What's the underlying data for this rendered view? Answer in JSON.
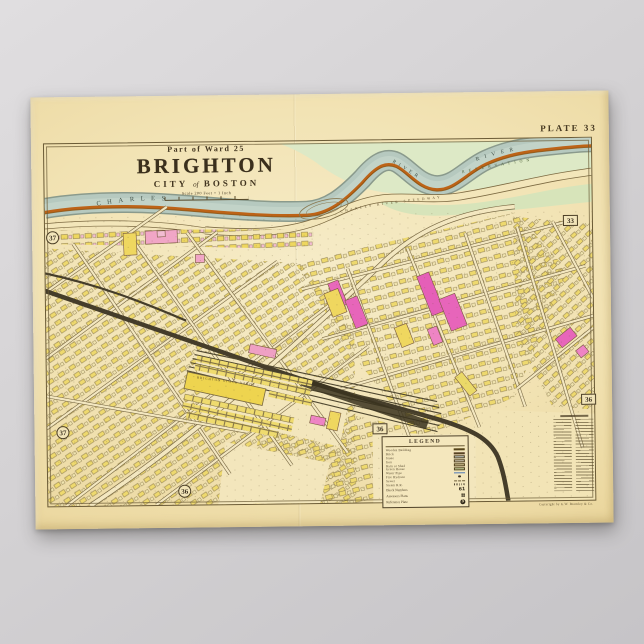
{
  "page": {
    "background_top": "#e0dee0",
    "background_bottom": "#c6c4c7"
  },
  "poster": {
    "plate_label": "PLATE 33",
    "title": {
      "ward": "Part of Ward 25",
      "name": "BRIGHTON",
      "city_word": "CITY",
      "of_word": "of",
      "boston_word": "BOSTON",
      "scale_text": "Scale 200 Feet = 1 Inch"
    },
    "publisher_credit": "Copyright by G.W. Bromley & Co.",
    "map_labels": {
      "river_left": "CHARLES",
      "river_bend": "RIVER",
      "river_right": "RIVER",
      "speedway": "CHARLES RIVER SPEEDWAY",
      "reservation": "RESERVATION",
      "stock_yards": "BRIGHTON STOCK YARDS"
    },
    "badges": [
      {
        "value": "37",
        "shape": "circle"
      },
      {
        "value": "33",
        "shape": "square"
      },
      {
        "value": "36",
        "shape": "square"
      },
      {
        "value": "37",
        "shape": "circle"
      },
      {
        "value": "36",
        "shape": "square"
      },
      {
        "value": "36",
        "shape": "circle"
      }
    ],
    "legend": {
      "title": "LEGEND",
      "rows": [
        {
          "label": "Wooden Building",
          "swatch": "#f1dd75",
          "type": "box"
        },
        {
          "label": "Brick",
          "swatch": "#f2a9c4",
          "type": "box"
        },
        {
          "label": "Stone",
          "swatch": "#c6d3da",
          "type": "box"
        },
        {
          "label": "Iron",
          "swatch": "#d8d2c2",
          "type": "box"
        },
        {
          "label": "Barn or Shed",
          "swatch": "#d9cd9b",
          "type": "box"
        },
        {
          "label": "Green House",
          "swatch": "#cfe0a6",
          "type": "box"
        },
        {
          "label": "Water Pipe",
          "swatch": "#4f79b5",
          "type": "line"
        },
        {
          "label": "Fire Hydrant",
          "swatch": "#3a3020",
          "type": "dot"
        },
        {
          "label": "Sewer",
          "swatch": "#6a5a34",
          "type": "dash"
        },
        {
          "label": "Steam R.R.",
          "swatch": "#3a3020",
          "type": "hatch"
        }
      ],
      "extras": [
        {
          "label": "Block Numbers",
          "value": "61"
        },
        {
          "label": "Assessors Plans",
          "value": "▦"
        },
        {
          "label": "Reference Plate",
          "value": "3"
        }
      ]
    },
    "colors": {
      "paper": "#f2e3b4",
      "ink": "#6b5b36",
      "river": "#b6c9bf",
      "reservation_green": "#dde9c6",
      "shore_orange": "#bd6317",
      "wood_yellow": "#efd75f",
      "brick_pink": "#f1a6c6",
      "magenta": "#e765ba",
      "railroad": "#453d2a"
    }
  }
}
